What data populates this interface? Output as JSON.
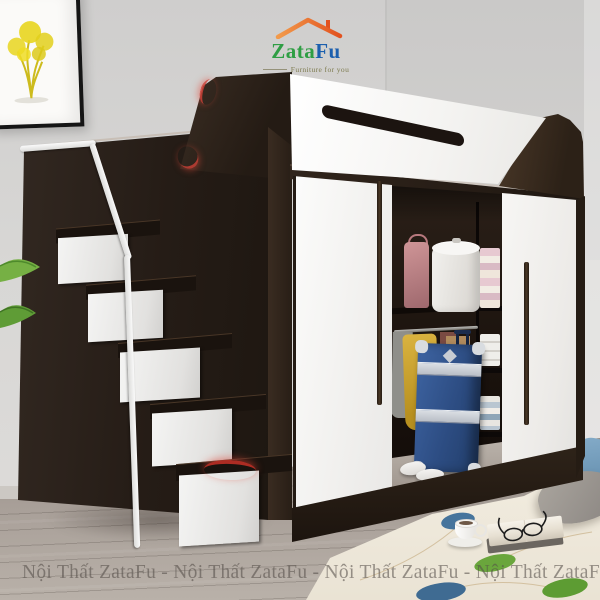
{
  "meta": {
    "type": "furniture-product-photo",
    "subject": "Loft bed with under-bed wardrobe, storage staircase drawers and white sliding doors"
  },
  "logo": {
    "name_part1": "Zata",
    "name_part2": "Fu",
    "tagline": "Furniture for you",
    "colors": {
      "roof": "#e2521f",
      "part1": "#2f9e44",
      "part2": "#1b5fae",
      "tagline": "#7d7a4e"
    }
  },
  "watermark": {
    "unit": "Nội Thất ZataFu",
    "separator": "-",
    "line": "Nội Thất ZataFu  -  Nội Thất ZataFu  -  Nội Thất ZataFu  -  Nội Thất ZataFu",
    "color": "#554e48"
  },
  "palette": {
    "wall": "#d6d5d3",
    "floor": "#a89f98",
    "wood_dark": "#261d16",
    "panel_white": "#f6f5f3",
    "accent_red": "#c0392b",
    "rug": "#efe9db",
    "leaf_green": "#6aa63c",
    "leaf_blue": "#46749c",
    "suitcase_blue": "#2e4f86"
  }
}
